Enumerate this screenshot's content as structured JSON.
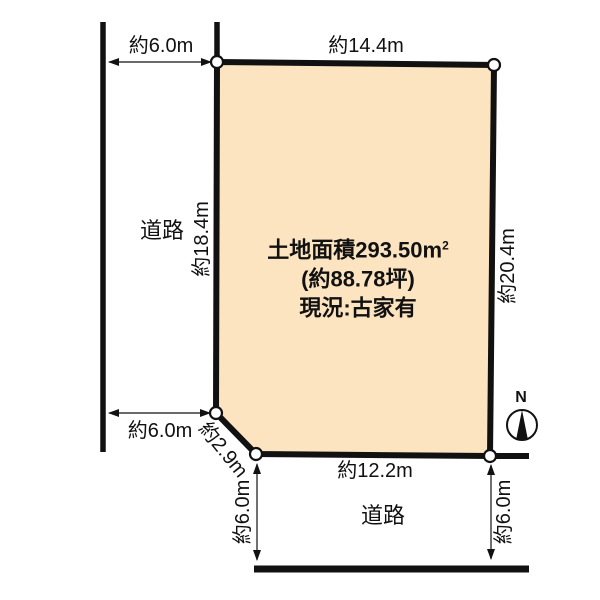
{
  "plot": {
    "fill_color": "#FCE4C1",
    "area_label_main": "土地面積293.50m",
    "area_label_sup": "2",
    "tsubo_label": "(約88.78坪)",
    "status_label": "現況:古家有"
  },
  "dimensions": {
    "west_road_width_top": "約6.0m",
    "north_edge": "約14.4m",
    "west_edge": "約18.4m",
    "east_edge": "約20.4m",
    "west_road_width_bottom": "約6.0m",
    "corner_cut": "約2.9m",
    "south_edge": "約12.2m",
    "south_road_width_left": "約6.0m",
    "south_road_width_right": "約6.0m"
  },
  "roads": {
    "west_label": "道路",
    "south_label": "道路"
  },
  "compass": {
    "north_label": "N"
  }
}
